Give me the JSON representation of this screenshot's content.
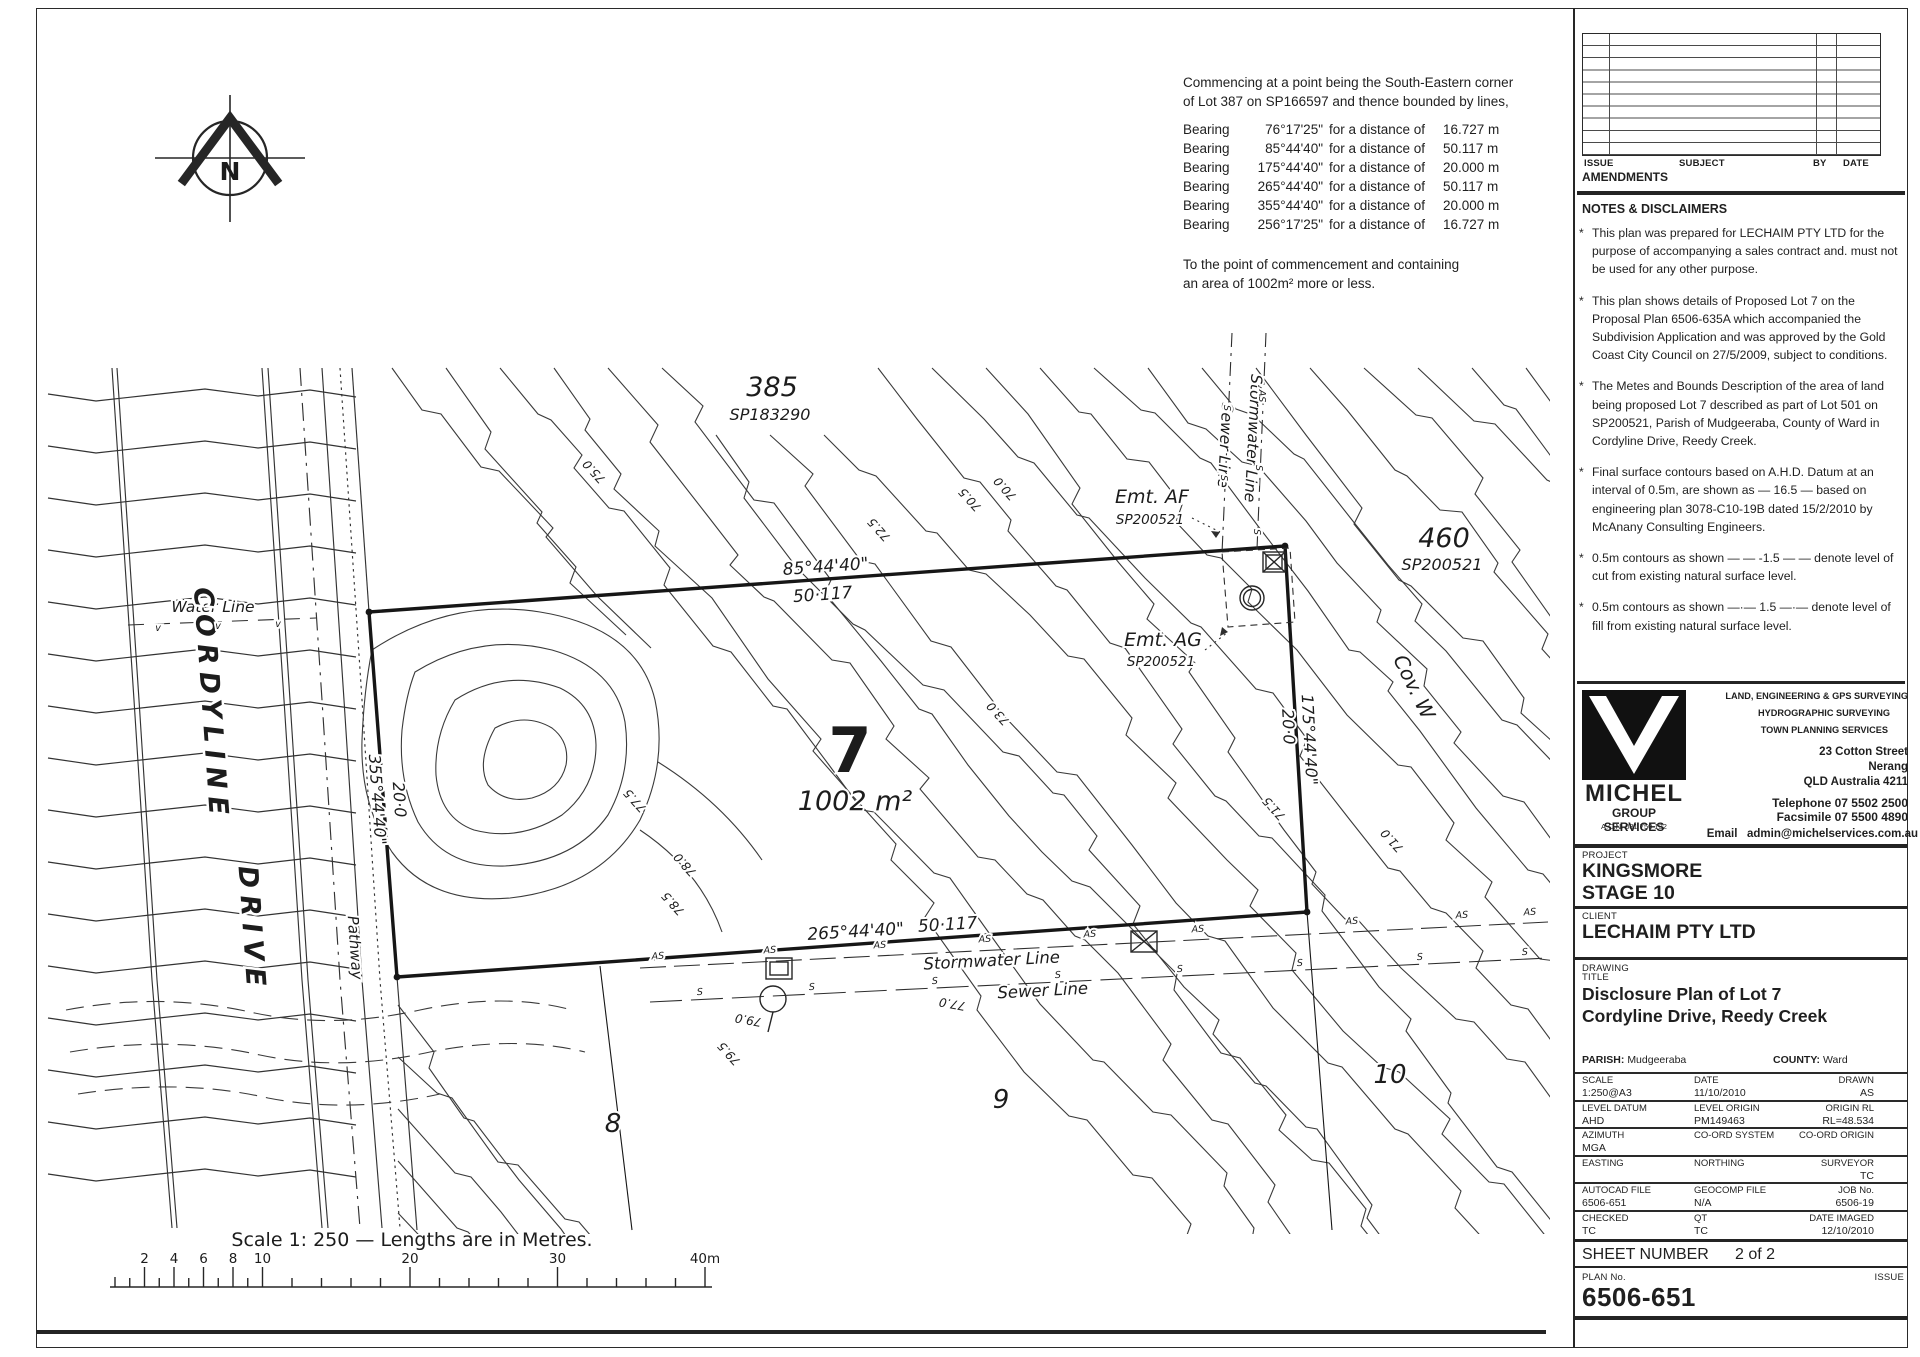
{
  "colors": {
    "ink": "#1f1f1f",
    "paper": "#ffffff"
  },
  "north_label": "N",
  "metes": {
    "line1": "Commencing at a point being the South-Eastern corner",
    "line2": "of Lot 387 on SP166597 and thence bounded by lines,",
    "rows": [
      {
        "b": "Bearing",
        "a": "76°17'25\"",
        "f": "for a distance of",
        "d": "16.727 m"
      },
      {
        "b": "Bearing",
        "a": "85°44'40\"",
        "f": "for a distance of",
        "d": "50.117 m"
      },
      {
        "b": "Bearing",
        "a": "175°44'40\"",
        "f": "for a distance of",
        "d": "20.000 m"
      },
      {
        "b": "Bearing",
        "a": "265°44'40\"",
        "f": "for a distance of",
        "d": "50.117 m"
      },
      {
        "b": "Bearing",
        "a": "355°44'40\"",
        "f": "for a distance of",
        "d": "20.000 m"
      },
      {
        "b": "Bearing",
        "a": "256°17'25\"",
        "f": "for a distance of",
        "d": "16.727 m"
      }
    ],
    "close1": "To the point of commencement and containing",
    "close2": "an area of 1002m² more or less."
  },
  "plan_labels": {
    "lot385": "385",
    "lot385_sp": "SP183290",
    "lot460": "460",
    "lot460_sp": "SP200521",
    "cov_w": "Cov. W",
    "lot7": "7",
    "lot7_area": "1002 m²",
    "lot8": "8",
    "lot9": "9",
    "lot10": "10",
    "emt_af": "Emt. AF",
    "emt_af_sp": "SP200521",
    "emt_ag": "Emt. AG",
    "emt_ag_sp": "SP200521",
    "water_line": "Water Line",
    "cordyline": "CORDYLINE",
    "drive": "DRIVE",
    "pathway": "Pathway",
    "stormwater_top": "Stormwater Line",
    "sewer_top": "Sewer Line",
    "stormwater_bottom": "Stormwater Line",
    "sewer_bottom": "Sewer Line",
    "bearing_top": "85°44'40\"",
    "dist_top": "50·117",
    "bearing_right": "175°44'40\"",
    "dist_right": "20·0",
    "bearing_bottom": "265°44'40\"",
    "dist_bottom": "50·117",
    "bearing_left": "355°44'40\"",
    "dist_left": "20·0"
  },
  "contour_labels": [
    {
      "t": "75.0",
      "x": 597,
      "y": 469,
      "r": 228
    },
    {
      "t": "72.5",
      "x": 882,
      "y": 527,
      "r": 228
    },
    {
      "t": "70.5",
      "x": 973,
      "y": 497,
      "r": 228
    },
    {
      "t": "70.0",
      "x": 1008,
      "y": 486,
      "r": 228
    },
    {
      "t": "73.0",
      "x": 1001,
      "y": 711,
      "r": 228
    },
    {
      "t": "71.5",
      "x": 1277,
      "y": 806,
      "r": 228
    },
    {
      "t": "71.0",
      "x": 1395,
      "y": 838,
      "r": 228
    },
    {
      "t": "77.5",
      "x": 638,
      "y": 798,
      "r": 228
    },
    {
      "t": "78.0",
      "x": 688,
      "y": 862,
      "r": 228
    },
    {
      "t": "78.5",
      "x": 676,
      "y": 901,
      "r": 228
    },
    {
      "t": "79.0",
      "x": 749,
      "y": 1016,
      "r": 190
    },
    {
      "t": "79.5",
      "x": 732,
      "y": 1051,
      "r": 228
    },
    {
      "t": "77.0",
      "x": 953,
      "y": 1000,
      "r": 190
    }
  ],
  "plan_marks": [
    {
      "t": "AS",
      "x": 658,
      "y": 959,
      "r": -3
    },
    {
      "t": "AS",
      "x": 770,
      "y": 953,
      "r": -3
    },
    {
      "t": "AS",
      "x": 880,
      "y": 948,
      "r": -3
    },
    {
      "t": "AS",
      "x": 985,
      "y": 942,
      "r": -3
    },
    {
      "t": "AS",
      "x": 1090,
      "y": 937,
      "r": -3
    },
    {
      "t": "AS",
      "x": 1198,
      "y": 932,
      "r": -3
    },
    {
      "t": "AS",
      "x": 1352,
      "y": 924,
      "r": -3
    },
    {
      "t": "AS",
      "x": 1462,
      "y": 918,
      "r": -3
    },
    {
      "t": "AS",
      "x": 1530,
      "y": 915,
      "r": -3
    },
    {
      "t": "S",
      "x": 700,
      "y": 995,
      "r": -3
    },
    {
      "t": "S",
      "x": 812,
      "y": 990,
      "r": -3
    },
    {
      "t": "S",
      "x": 935,
      "y": 984,
      "r": -3
    },
    {
      "t": "S",
      "x": 1058,
      "y": 978,
      "r": -3
    },
    {
      "t": "S",
      "x": 1180,
      "y": 972,
      "r": -3
    },
    {
      "t": "S",
      "x": 1300,
      "y": 966,
      "r": -3
    },
    {
      "t": "S",
      "x": 1420,
      "y": 960,
      "r": -3
    },
    {
      "t": "S",
      "x": 1525,
      "y": 955,
      "r": -3
    },
    {
      "t": "S",
      "x": 1224,
      "y": 408,
      "r": 90
    },
    {
      "t": "S",
      "x": 1221,
      "y": 478,
      "r": 90
    },
    {
      "t": "AS",
      "x": 1259,
      "y": 396,
      "r": 90
    },
    {
      "t": "S",
      "x": 1256,
      "y": 468,
      "r": 90
    },
    {
      "t": "S",
      "x": 1254,
      "y": 532,
      "r": 90
    },
    {
      "t": "v",
      "x": 158,
      "y": 631,
      "r": 0
    },
    {
      "t": "v",
      "x": 218,
      "y": 629,
      "r": 0
    },
    {
      "t": "v",
      "x": 278,
      "y": 627,
      "r": 0
    }
  ],
  "scalebar": {
    "title": "Scale  1: 250 — Lengths are in Metres.",
    "x0": 115,
    "ppm": 14.75,
    "y": 1287,
    "ticks_labeled": [
      {
        "t": "2",
        "m": 2
      },
      {
        "t": "4",
        "m": 4
      },
      {
        "t": "6",
        "m": 6
      },
      {
        "t": "8",
        "m": 8
      },
      {
        "t": "10",
        "m": 10
      },
      {
        "t": "20",
        "m": 20
      },
      {
        "t": "30",
        "m": 30
      },
      {
        "t": "40m",
        "m": 40
      }
    ]
  },
  "titleblock": {
    "bullet": "*",
    "amend_headers": {
      "issue": "ISSUE",
      "subject": "SUBJECT",
      "by": "BY",
      "date": "DATE"
    },
    "amendments_label": "AMENDMENTS",
    "notes_heading": "NOTES & DISCLAIMERS",
    "notes": [
      "This plan was prepared for LECHAIM PTY LTD for the purpose of accompanying a sales contract and. must not be used for any other purpose.",
      "This plan shows details of Proposed Lot 7 on the Proposal Plan 6506-635A which accompanied the Subdivision Application and was approved by the Gold Coast City Council on 27/5/2009, subject to conditions.",
      "The Metes and Bounds Description of the area of land being proposed Lot 7 described as part of Lot 501 on SP200521, Parish of Mudgeeraba, County of Ward in Cordyline Drive, Reedy Creek.",
      "Final surface contours based on A.H.D. Datum at an interval of 0.5m, are shown as  — 16.5 —  based on engineering plan 3078-C10-19B dated 15/2/2010 by McAnany Consulting Engineers.",
      "0.5m contours as shown  — —  -1.5  — — denote level of cut from existing natural surface level.",
      "0.5m contours as shown  —·—  1.5  —·— denote level of fill from existing natural surface level."
    ],
    "firm": {
      "name": "MICHEL",
      "name2": "GROUP SERVICES",
      "acn": "A.C.N. 081 750 132",
      "svc1": "LAND, ENGINEERING & GPS SURVEYING",
      "svc2": "HYDROGRAPHIC  SURVEYING",
      "svc3": "TOWN  PLANNING  SERVICES",
      "addr1": "23 Cotton Street",
      "addr2": "Nerang",
      "addr3": "QLD  Australia  4211",
      "phone": "Telephone  07 5502 2500",
      "fax": "Facsimile  07  5500 4890",
      "email_label": "Email",
      "email": "admin@michelservices.com.au"
    },
    "project_label": "PROJECT",
    "project1": "KINGSMORE",
    "project2": "STAGE 10",
    "client_label": "CLIENT",
    "client": "LECHAIM PTY LTD",
    "drawing_label": "DRAWING",
    "title_label": "TITLE",
    "title1": "Disclosure Plan of Lot 7",
    "title2": "Cordyline Drive, Reedy Creek",
    "parish_label": "PARISH:",
    "parish": "Mudgeeraba",
    "county_label": "COUNTY:",
    "county": "Ward",
    "info_rows": [
      [
        {
          "l": "SCALE",
          "v": "1:250@A3"
        },
        {
          "l": "DATE",
          "v": "11/10/2010"
        },
        {
          "l": "DRAWN",
          "v": "AS"
        }
      ],
      [
        {
          "l": "LEVEL DATUM",
          "v": "AHD"
        },
        {
          "l": "LEVEL ORIGIN",
          "v": "PM149463"
        },
        {
          "l": "ORIGIN RL",
          "v": "RL=48.534"
        }
      ],
      [
        {
          "l": "AZIMUTH",
          "v": "MGA"
        },
        {
          "l": "CO-ORD SYSTEM",
          "v": ""
        },
        {
          "l": "CO-ORD ORIGIN",
          "v": ""
        }
      ],
      [
        {
          "l": "EASTING",
          "v": ""
        },
        {
          "l": "NORTHING",
          "v": ""
        },
        {
          "l": "SURVEYOR",
          "v": "TC"
        }
      ],
      [
        {
          "l": "AUTOCAD FILE",
          "v": "6506-651"
        },
        {
          "l": "GEOCOMP FILE",
          "v": "N/A"
        },
        {
          "l": "JOB No.",
          "v": "6506-19"
        }
      ],
      [
        {
          "l": "CHECKED",
          "v": "TC"
        },
        {
          "l": "QT",
          "v": "TC"
        },
        {
          "l": "DATE IMAGED",
          "v": "12/10/2010"
        }
      ]
    ],
    "sheet_label": "SHEET NUMBER",
    "sheet_value": "2 of 2",
    "planno_label": "PLAN No.",
    "issue_label": "ISSUE",
    "plan_no": "6506-651"
  }
}
